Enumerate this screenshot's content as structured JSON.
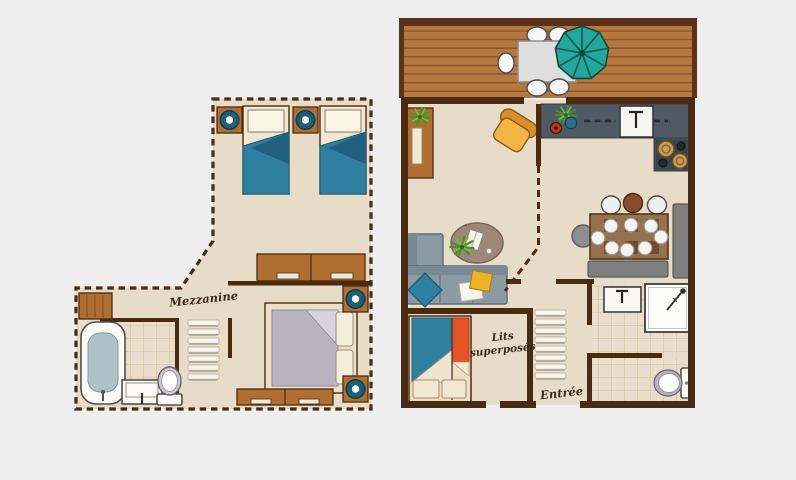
{
  "labels": {
    "mezzanine": "Mezzanine",
    "bunk_line1": "Lits",
    "bunk_line2": "superposés",
    "entrance": "Entrée"
  },
  "colors": {
    "background": "#efeff0",
    "floor": "#e7dcc7",
    "wall_brown": "#4a2b12",
    "deck_wood": "#b5793f",
    "parasol_teal": "#22a89c",
    "bed_blue": "#2e7fa0",
    "bunk_orange": "#e65325",
    "armchair_yellow": "#f1b445",
    "sofa_gray": "#8a9ba4",
    "counter_gray": "#4e5a64",
    "furniture_wood": "#b06f31",
    "lamp_teal": "#1d5e79"
  }
}
